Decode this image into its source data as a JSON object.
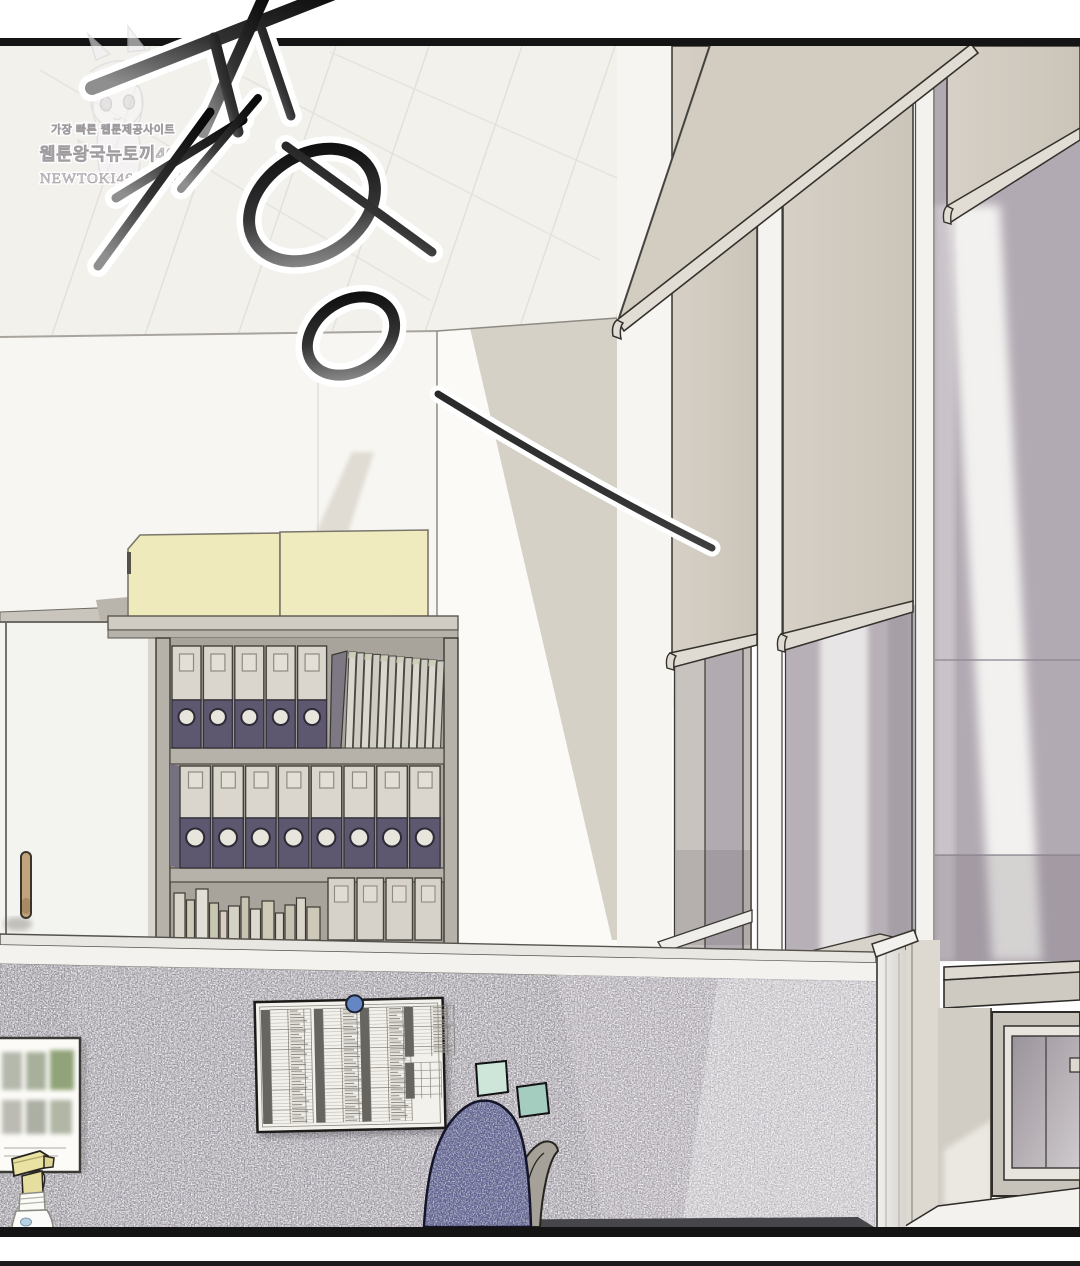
{
  "panel": {
    "kind": "webtoon comic panel",
    "scene": "empty office: cubicle partition, bookshelf with binders, windows with roller blinds"
  },
  "watermark": {
    "tagline": "가장 빠른 웹툰제공사이트",
    "sitename": "웹툰왕국뉴토끼469",
    "url": "NEWTOKI469.COM"
  },
  "sfx": {
    "text": "쏘옹",
    "trail_dash": "—"
  },
  "counts": {
    "yellow_boxes": 2,
    "top_shelf_binders": 5,
    "slanted_files": 12,
    "middle_shelf_binders": 8,
    "bottom_box_files": 4,
    "bottom_books": 13,
    "window_bays": 3,
    "sticky_notes": 2,
    "table_column_groups": 4
  },
  "colors": {
    "ink": "#141414",
    "binder_dark": "#5d5870",
    "binder_light": "#dad6cd",
    "blind_beige": "#d2ccc1",
    "wall_shadow": "#d6d1c7",
    "partition": "#9d97a0",
    "partition_mid": "#aca5ad",
    "partition_light": "#c7c3c8",
    "sticky_note_1": "#cde6d9",
    "sticky_note_2": "#a5cdbf",
    "chair_fabric": "#5e6290",
    "push_pin": "#6487c4",
    "yellow_box": "#eeeabb",
    "spray_trigger": "#eae2a2",
    "glass": "#b2aab3",
    "table_bar": "#67655f"
  }
}
